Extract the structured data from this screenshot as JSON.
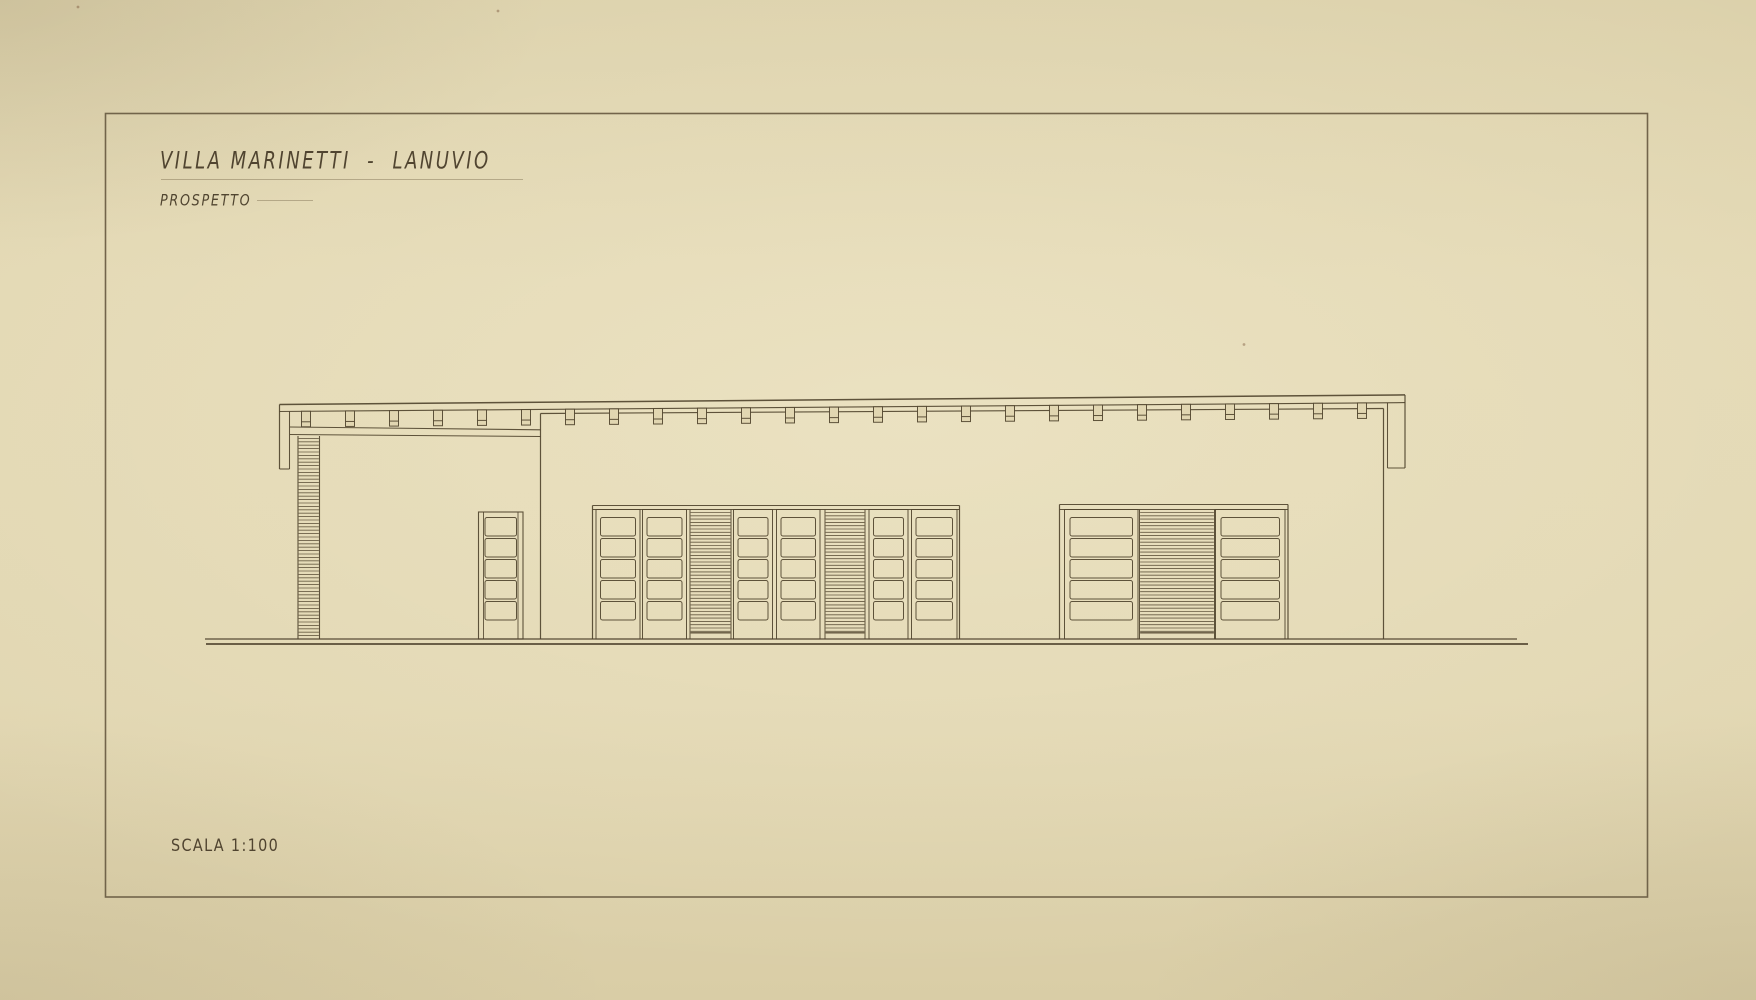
{
  "titleblock": {
    "title": "VILLA MARINETTI  -  LANUVIO",
    "subtitle": "PROSPETTO",
    "scale_label": "SCALA 1:100"
  },
  "palette": {
    "paper": "#e1d6b1",
    "paper_light": "#e7ddb9",
    "paper_shadow": "#cfc29b",
    "ink": "#51452f",
    "ink_strong": "#463a27",
    "ink_faint": "rgba(104,90,60,0.38)",
    "hatch_ink": "#5a4d36",
    "frame_line": "#6b5e45"
  },
  "drawing": {
    "frame": {
      "x": 105.5,
      "y": 113.5,
      "w": 1542,
      "h": 783.5
    },
    "ground": {
      "lines": [
        [
          205,
          639,
          1517,
          639
        ],
        [
          206,
          644,
          1528,
          644
        ]
      ]
    },
    "roof": {
      "fascia_top": [
        279.5,
        404.5,
        1405,
        394.9
      ],
      "fascia_bottom": [
        279.5,
        411.5,
        1405,
        402.6
      ],
      "left_return": {
        "outer": 279.5,
        "inner": 289.5,
        "bottom": 469
      },
      "right_return": {
        "inner": 1387.5,
        "outer": 1405,
        "bottom": 468
      },
      "rafters": {
        "x0": 306,
        "spacing": 44,
        "count": 25,
        "w": 9,
        "len": 15.5,
        "bar": 10.5
      }
    },
    "left_wing": {
      "band": [
        [
          290,
          427,
          540.5,
          429.8
        ],
        [
          290,
          434.5,
          540.5,
          436.5
        ]
      ],
      "hatch": {
        "x1": 298,
        "x2": 319.5,
        "top": 436,
        "bottom": 639,
        "step": 3.4
      }
    },
    "main_block": {
      "top": [
        540.5,
        413.5,
        1383.5,
        408.5
      ],
      "left_x": 540.5,
      "right_x": 1383.5,
      "base": 639
    },
    "entry_door": {
      "x": 478.5,
      "w": 44.5,
      "top": 512,
      "frame_inset": 5,
      "panel_inset": 6.5
    },
    "panel_rows": {
      "y0": 517.5,
      "step": 21,
      "h": 18.5,
      "count": 5
    },
    "center_group": {
      "x1": 592.5,
      "x2": 959.5,
      "band_y": [
        505.5,
        509.5
      ],
      "panel_inset": 4.5,
      "items": [
        {
          "type": "leaf",
          "x": 596,
          "w": 44
        },
        {
          "type": "leaf",
          "x": 642.5,
          "w": 44
        },
        {
          "type": "louver",
          "x": 690,
          "w": 41
        },
        {
          "type": "leaf",
          "x": 733.5,
          "w": 39
        },
        {
          "type": "leaf",
          "x": 776.5,
          "w": 43.5
        },
        {
          "type": "louver",
          "x": 825,
          "w": 40
        },
        {
          "type": "leaf",
          "x": 869,
          "w": 39
        },
        {
          "type": "leaf",
          "x": 911.5,
          "w": 45.5
        }
      ]
    },
    "right_group": {
      "x1": 1059.5,
      "x2": 1288,
      "band_y": [
        504.5,
        509.5
      ],
      "panel_inset": 5.5,
      "items": [
        {
          "type": "leaf",
          "x": 1064.5,
          "w": 73.5
        },
        {
          "type": "louver",
          "x": 1139.5,
          "w": 75
        },
        {
          "type": "leaf",
          "x": 1215.5,
          "w": 69.5
        }
      ]
    },
    "annotations": {
      "faint_lines": [
        [
          161,
          179.5,
          523,
          179.5
        ],
        [
          257,
          200.5,
          313,
          200.5
        ]
      ],
      "specks": [
        [
          498,
          11
        ],
        [
          1244,
          344.5
        ],
        [
          78,
          7
        ]
      ]
    }
  }
}
